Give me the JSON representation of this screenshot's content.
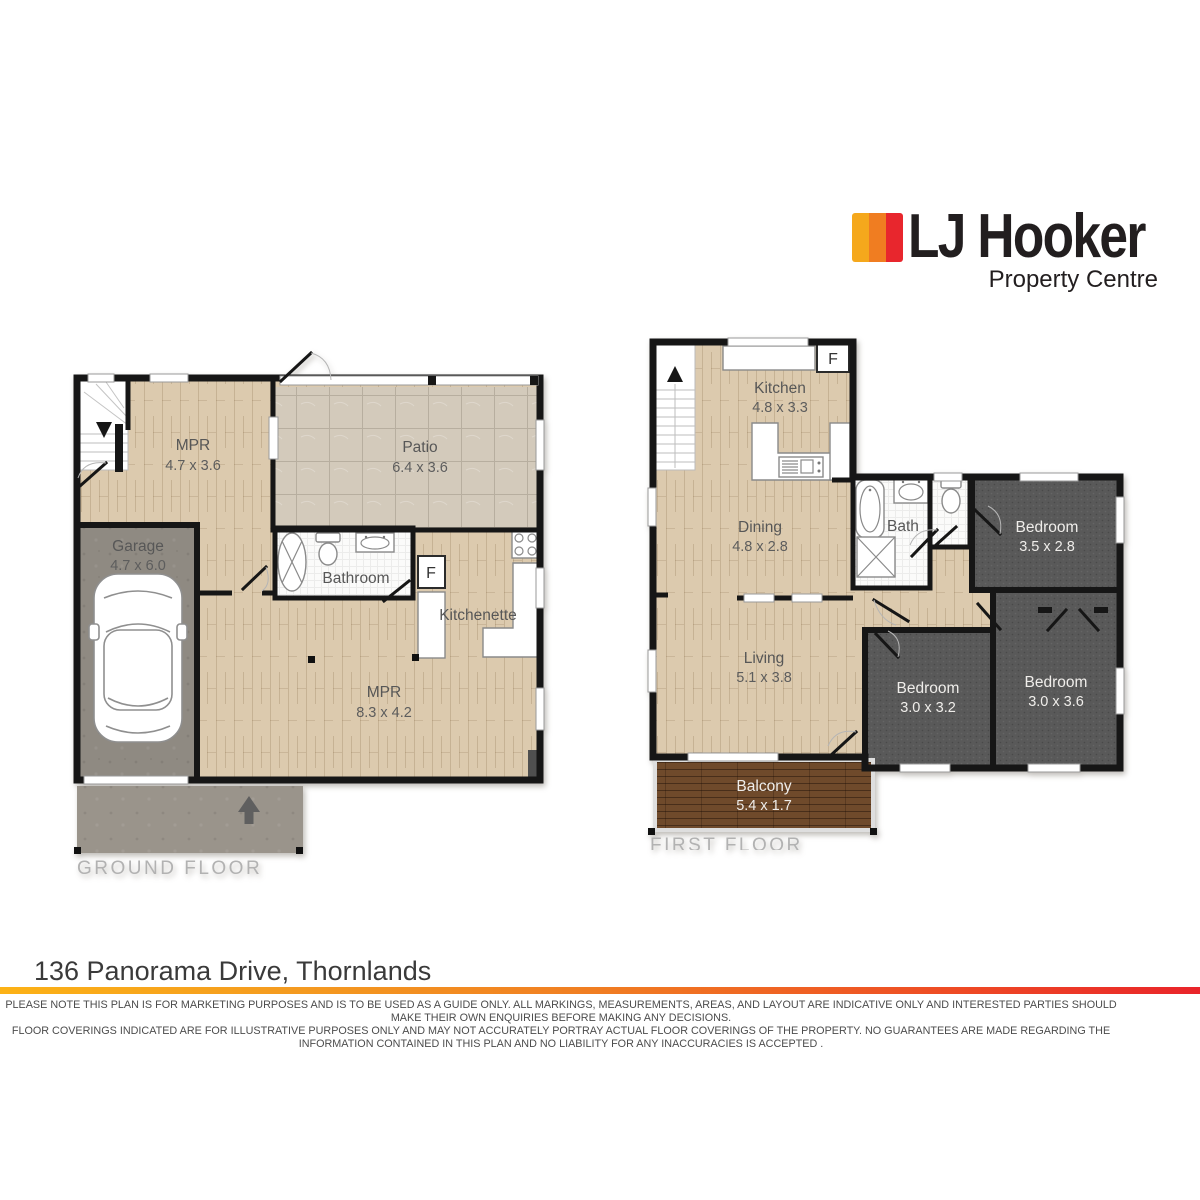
{
  "logo": {
    "brand": "LJ Hooker",
    "sub": "Property Centre"
  },
  "colors": {
    "brand_yellow": "#F5A81C",
    "brand_orange": "#F07D21",
    "brand_red": "#E8262D",
    "wall": "#161616",
    "wood": "#dccaae",
    "tile": "#d3cabb",
    "concrete": "#8f8a82",
    "carpet": "#595959",
    "deck": "#6f4a2b"
  },
  "ground": {
    "caption": "GROUND FLOOR",
    "mpr1": {
      "name": "MPR",
      "dims": "4.7 x 3.6"
    },
    "patio": {
      "name": "Patio",
      "dims": "6.4 x 3.6"
    },
    "garage": {
      "name": "Garage",
      "dims": "4.7 x 6.0"
    },
    "bathroom": {
      "name": "Bathroom"
    },
    "kitchenette": {
      "name": "Kitchenette"
    },
    "mpr2": {
      "name": "MPR",
      "dims": "8.3 x 4.2"
    },
    "fridge": "F"
  },
  "first": {
    "caption": "FIRST FLOOR",
    "kitchen": {
      "name": "Kitchen",
      "dims": "4.8 x 3.3"
    },
    "dining": {
      "name": "Dining",
      "dims": "4.8 x 2.8"
    },
    "bath": {
      "name": "Bath"
    },
    "bed1": {
      "name": "Bedroom",
      "dims": "3.5 x 2.8"
    },
    "living": {
      "name": "Living",
      "dims": "5.1 x 3.8"
    },
    "bed2": {
      "name": "Bedroom",
      "dims": "3.0 x 3.2"
    },
    "bed3": {
      "name": "Bedroom",
      "dims": "3.0 x 3.6"
    },
    "balcony": {
      "name": "Balcony",
      "dims": "5.4 x 1.7"
    },
    "fridge": "F"
  },
  "footer": {
    "address": "136 Panorama Drive, Thornlands",
    "disclaimer1": "PLEASE NOTE THIS PLAN IS FOR MARKETING PURPOSES AND IS TO BE USED AS A GUIDE ONLY.  ALL MARKINGS, MEASUREMENTS, AREAS, AND LAYOUT ARE INDICATIVE ONLY AND INTERESTED PARTIES SHOULD MAKE THEIR OWN ENQUIRIES BEFORE MAKING ANY DECISIONS.",
    "disclaimer2": "FLOOR COVERINGS INDICATED ARE FOR ILLUSTRATIVE PURPOSES ONLY AND MAY NOT ACCURATELY PORTRAY ACTUAL FLOOR COVERINGS OF THE PROPERTY.  NO GUARANTEES ARE MADE REGARDING THE INFORMATION CONTAINED IN THIS PLAN AND NO LIABILITY FOR  ANY INACCURACIES IS ACCEPTED ."
  }
}
